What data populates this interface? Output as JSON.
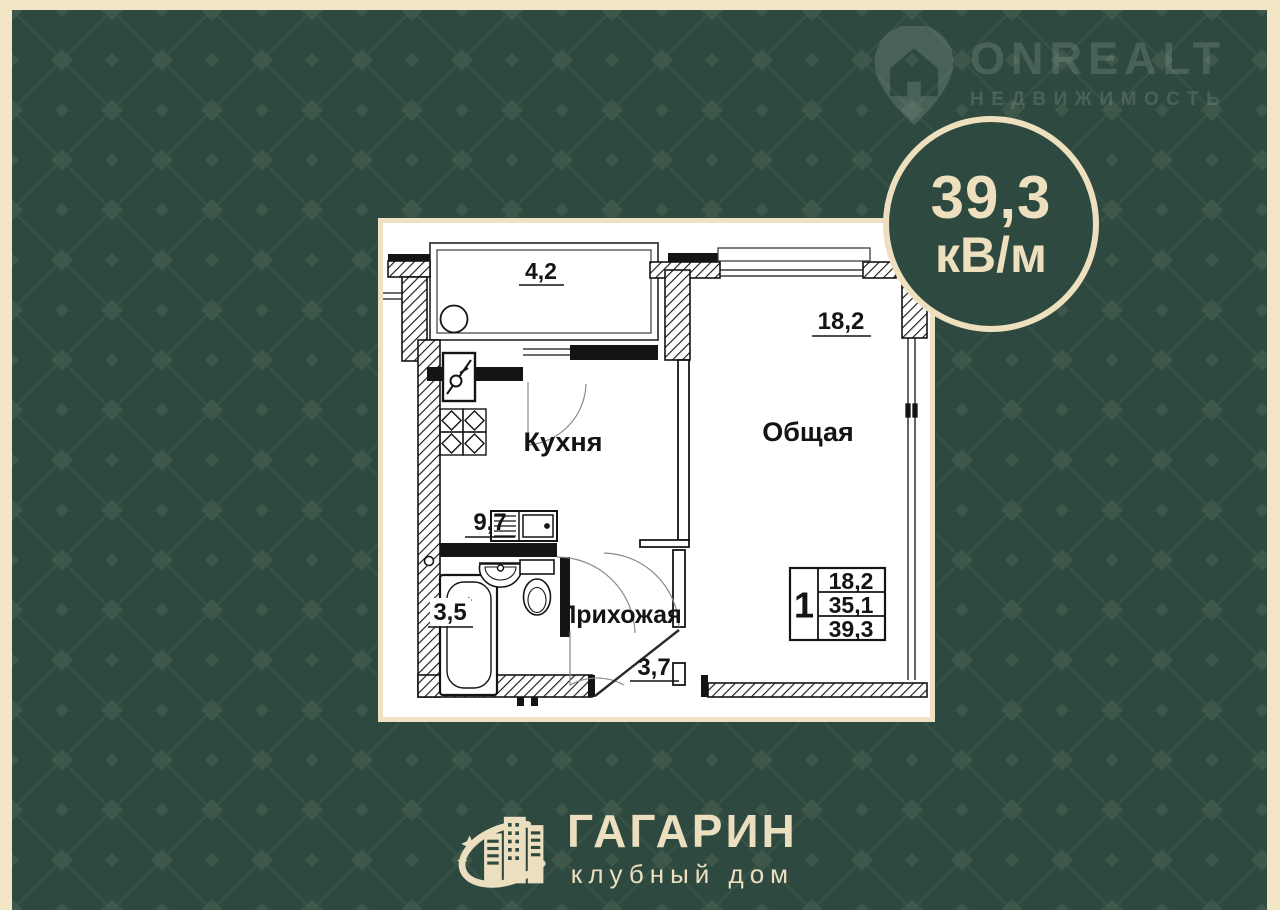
{
  "badge": {
    "area": "39,3",
    "unit": "кВ/м"
  },
  "watermark": {
    "brand": "ONREALT",
    "tagline": "НЕДВИЖИМОСТЬ"
  },
  "developer": {
    "name": "ГАГАРИН",
    "subtitle": "клубный дом"
  },
  "floor_plan": {
    "labels": {
      "kitchen": "Кухня",
      "living": "Общая",
      "hallway": "Прихожая"
    },
    "areas": {
      "balcony": "4,2",
      "living": "18,2",
      "kitchen": "9,7",
      "bathroom": "3,5",
      "hallway": "3,7"
    },
    "summary_table": {
      "rooms_count": "1",
      "living_area": "18,2",
      "floor_area": "35,1",
      "total_area": "39,3"
    }
  },
  "colors": {
    "background_green": "#2e4a40",
    "pattern_green": "#3d574b",
    "cream": "#eee0bf",
    "plan_line": "#141414",
    "plan_bg": "#ffffff"
  }
}
